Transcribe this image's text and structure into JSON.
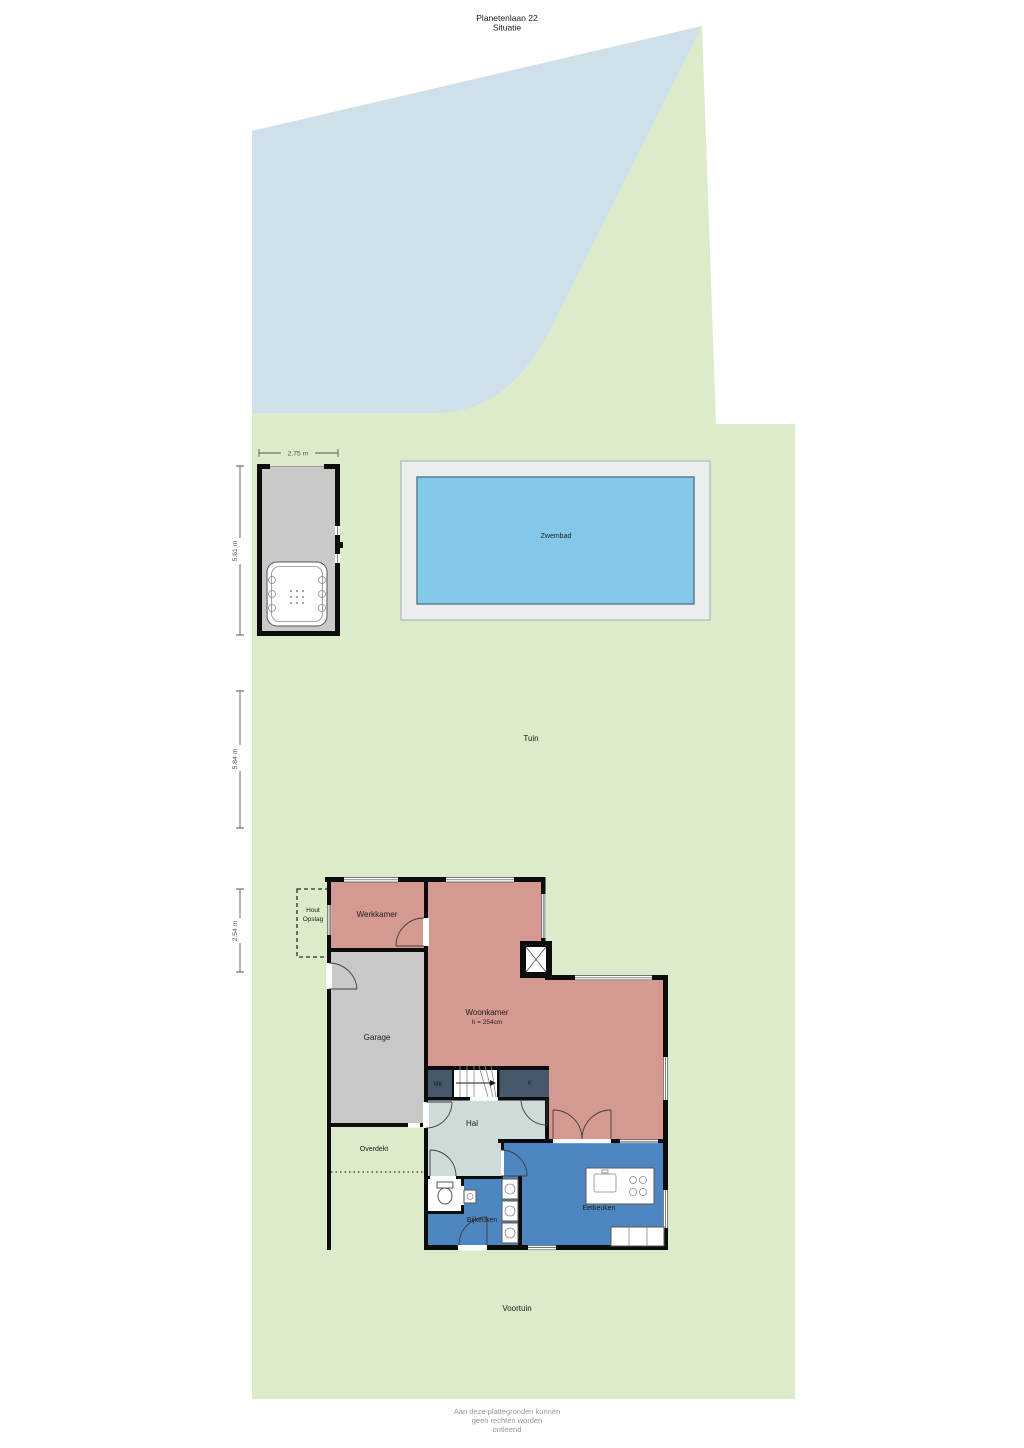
{
  "title": {
    "line1": "Planetenlaan 22",
    "line2": "Situatie"
  },
  "areas": {
    "garden": "Tuin",
    "front_garden": "Voortuin",
    "pool": "Zwembad",
    "covered": "Overdekt",
    "wood_storage_line1": "Hout",
    "wood_storage_line2": "Opslag"
  },
  "rooms": {
    "office": "Werkkamer",
    "living": "Woonkamer",
    "living_height": "h = 254cm",
    "garage": "Garage",
    "meter_closet": "MK",
    "closet": "K",
    "hall": "Hal",
    "utility": "Bijkeuken",
    "kitchen": "Eetkeuken"
  },
  "dimensions": {
    "shed_width": "2.75 m",
    "shed_depth": "5.61 m",
    "garden_span_upper": "5.84 m",
    "garden_span_lower": "2.54 m"
  },
  "footer": {
    "line1": "Aan deze plattegronden kunnen",
    "line2": "geen rechten worden",
    "line3": "ontleend"
  },
  "colors": {
    "grass": "#dcecca",
    "water": "#cfe0eb",
    "pool_deck": "#eaeeee",
    "pool_water": "#84c8e7",
    "pool_border": "#5d7f8f",
    "room_pink": "#d49a92",
    "room_gray": "#c8c8c6",
    "room_dark": "#46586a",
    "hall": "#cddcdb",
    "kitchen_blue": "#4e86c2",
    "shed": "#c9c9c7",
    "wall": "#0c0c0c",
    "dim_line": "#555555",
    "text": "#1c1c1c",
    "footer": "#979797"
  }
}
